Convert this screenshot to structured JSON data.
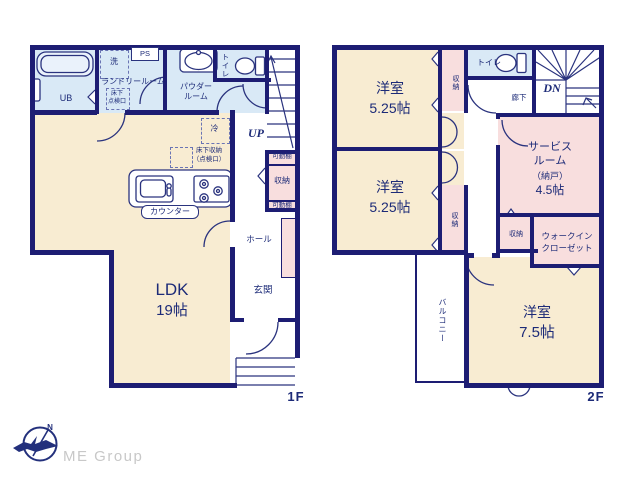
{
  "palette": {
    "wall_navy": "#1d1d73",
    "text_navy": "#1d2b78",
    "tatami_cream": "#f8ecd2",
    "wet_area_blue": "#d9e9f6",
    "closet_pink": "#f8dede",
    "window_lavender": "#a9b3d6",
    "logo_gray": "#c8c8c8",
    "logo_navy": "#23307c"
  },
  "f1": {
    "label": "1F",
    "ub": "UB",
    "laundry_room": "ランドリールーム",
    "washer": "洗",
    "ps": "PS",
    "hatch_l1": "床下",
    "hatch_l2": "点検口",
    "powder_l1": "パウダー",
    "powder_l2": "ルーム",
    "toilet": "トイレ",
    "fridge": "冷",
    "underfloor_l1": "床下収納",
    "underfloor_l2": "（点検口）",
    "counter": "カウンター",
    "up": "UP",
    "shelf_top": "可動棚",
    "closet": "収納",
    "shelf_bottom": "可動棚",
    "hall": "ホール",
    "ldk_name": "LDK",
    "ldk_size": "19帖",
    "entrance": "玄関"
  },
  "f2": {
    "label": "2F",
    "room1_name": "洋室",
    "room1_size": "5.25帖",
    "room1_closet": "収納",
    "toilet": "トイレ",
    "dn": "DN",
    "corridor": "廊下",
    "room2_name": "洋室",
    "room2_size": "5.25帖",
    "room2_closet": "収納",
    "service_l1": "サービス",
    "service_l2": "ルーム",
    "service_l3": "（納戸）",
    "service_l4": "4.5帖",
    "closet_small": "収納",
    "wic_l1": "ウォークイン",
    "wic_l2": "クローゼット",
    "balcony": "バルコニー",
    "room3_name": "洋室",
    "room3_size": "7.5帖"
  },
  "logo": {
    "text": "ME Group",
    "compass_n": "N"
  }
}
